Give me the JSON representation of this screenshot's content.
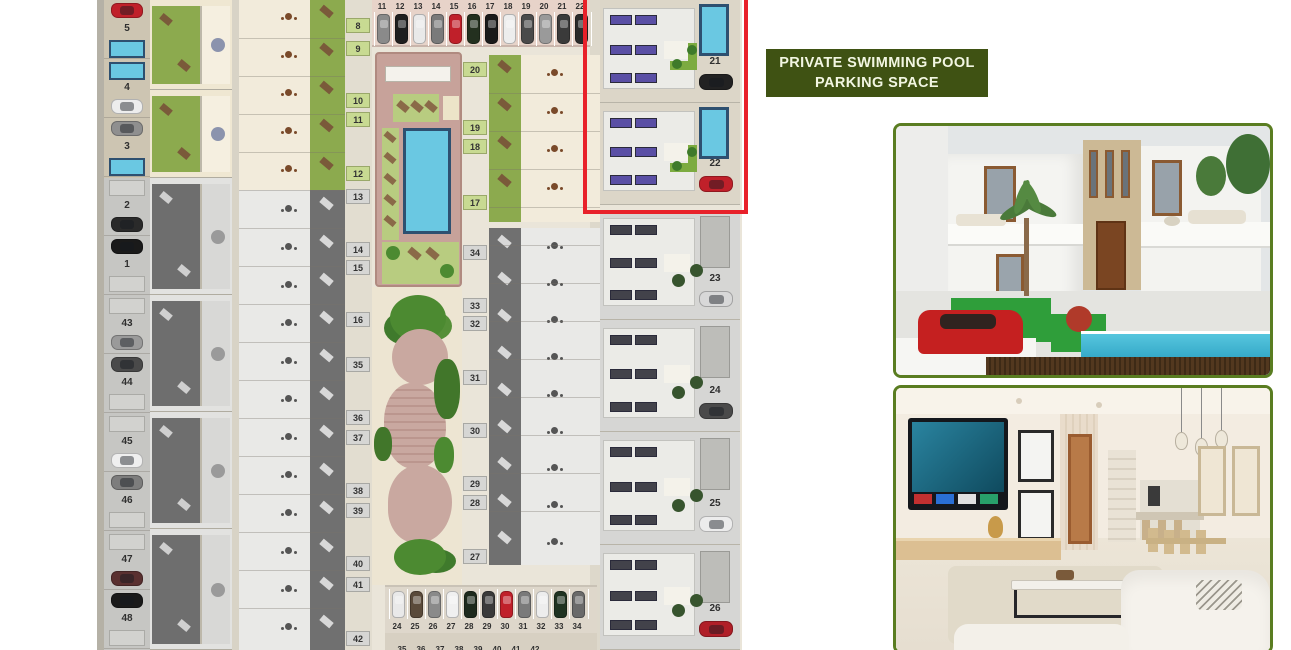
{
  "annotation_box": {
    "line1": "PRIVATE SWIMMING POOL",
    "line2": "PARKING SPACE"
  },
  "highlight": {
    "color": "#e8212a",
    "highlighted_plots": [
      "21",
      "22"
    ]
  },
  "palette": {
    "annotation_bg": "#3f5213",
    "annotation_text": "#f2f6e2",
    "photo_border": "#5a7d21",
    "pool_water": "#6ac8e2",
    "solar_panel_purple": "#5a4fa5",
    "garden_green": "#8caa4e",
    "plan_base": "#eae5d9"
  },
  "site_plan": {
    "left_plots": [
      {
        "number": "5",
        "car": "#c0202a"
      },
      {
        "number": "4",
        "car": "#ededed"
      },
      {
        "number": "3",
        "car": "#8f8f8f"
      },
      {
        "number": "2",
        "car": "#2a2a2a"
      },
      {
        "number": "1",
        "car": "#1a1a1a"
      },
      {
        "number": "43",
        "car": "#9a9a9a"
      },
      {
        "number": "44",
        "car": "#4a4a4a"
      },
      {
        "number": "45",
        "car": "#efefef"
      },
      {
        "number": "46",
        "car": "#7d7d7d"
      },
      {
        "number": "47",
        "car": "#5a3030"
      },
      {
        "number": "48",
        "car": "#1a1a1a"
      }
    ],
    "mid_strip": {
      "green_labels": [
        "8",
        "9",
        "10",
        "11",
        "12"
      ],
      "gray_labels": [
        "13",
        "14",
        "15",
        "16",
        "35",
        "36",
        "37",
        "38",
        "39",
        "40",
        "41",
        "42"
      ]
    },
    "east_row_labels": {
      "colored": [
        "20",
        "19",
        "18",
        "17"
      ],
      "gray": [
        "34",
        "33",
        "32",
        "31",
        "30",
        "29",
        "28",
        "27"
      ]
    },
    "right_villas": [
      {
        "number": "21",
        "car": "#222222",
        "pool": true,
        "panels": "#5a4fa5",
        "highlighted": true
      },
      {
        "number": "22",
        "car": "#c0202a",
        "pool": true,
        "panels": "#5a4fa5",
        "highlighted": true
      },
      {
        "number": "23",
        "car": "#d8d8d8",
        "pool": false,
        "panels": "#42424a",
        "highlighted": false
      },
      {
        "number": "24",
        "car": "#4a4a4a",
        "pool": false,
        "panels": "#42424a",
        "highlighted": false
      },
      {
        "number": "25",
        "car": "#ececec",
        "pool": false,
        "panels": "#42424a",
        "highlighted": false
      },
      {
        "number": "26",
        "car": "#b01f28",
        "pool": false,
        "panels": "#42424a",
        "highlighted": false
      }
    ],
    "top_parking": {
      "numbers": [
        "11",
        "12",
        "13",
        "14",
        "15",
        "16",
        "17",
        "18",
        "19",
        "20",
        "21",
        "22"
      ],
      "car_colors": [
        "#8a8a8a",
        "#1f1f1f",
        "#e9e9e9",
        "#7a7a7a",
        "#c0202a",
        "#23301f",
        "#1a1a1a",
        "#ededed",
        "#4a4a4a",
        "#9a9a9a",
        "#3a3a3a",
        "#2a2a2a"
      ]
    },
    "bottom_parking": {
      "numbers": [
        "24",
        "25",
        "26",
        "27",
        "28",
        "29",
        "30",
        "31",
        "32",
        "33",
        "34"
      ],
      "car_colors": [
        "#e9e9e9",
        "#5a4a3a",
        "#8a8a8a",
        "#f0f0f0",
        "#1d2a1d",
        "#3a3a3a",
        "#c0202a",
        "#7a7a7a",
        "#ededed",
        "#1f3322",
        "#6a6a6a"
      ],
      "row2_numbers": [
        "35",
        "36",
        "37",
        "38",
        "39",
        "40",
        "41",
        "42"
      ]
    }
  }
}
